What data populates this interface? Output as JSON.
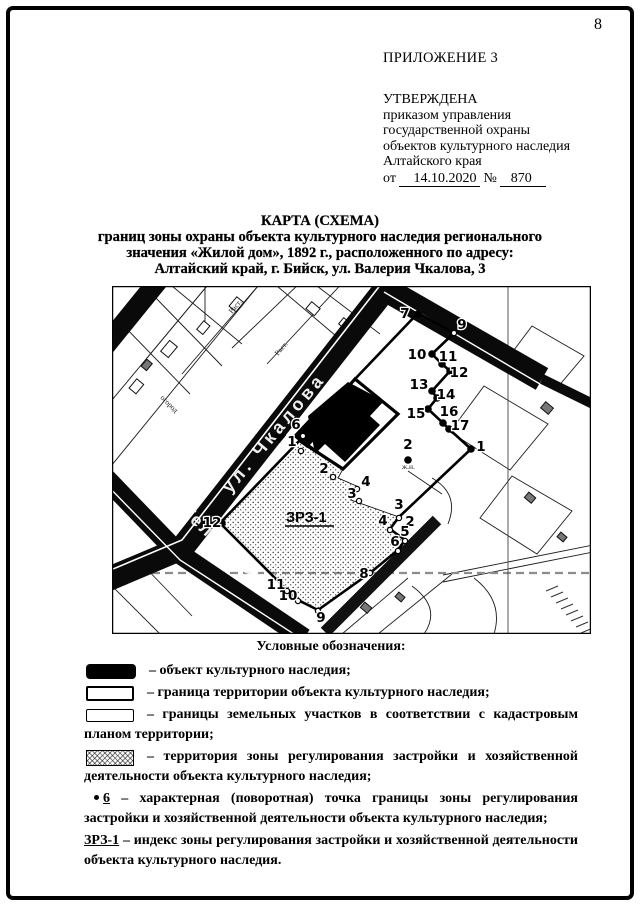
{
  "page": {
    "number": "8"
  },
  "header": {
    "appendix": "ПРИЛОЖЕНИЕ 3",
    "approval_lines": [
      "УТВЕРЖДЕНА",
      "приказом управления",
      "государственной охраны",
      "объектов культурного наследия",
      "Алтайского края"
    ],
    "order_prefix": "от",
    "order_date": "14.10.2020",
    "order_no_sign": "№",
    "order_number": "870"
  },
  "title": {
    "line1": "КАРТА (СХЕМА)",
    "line2": "границ зоны охраны объекта культурного наследия регионального",
    "line3": "значения «Жилой дом», 1892 г., расположенного по адресу:",
    "line4": "Алтайский край, г. Бийск, ул. Валерия Чкалова, 3"
  },
  "map": {
    "streets": [
      {
        "name": "ул. Чкалова"
      },
      {
        "name": "пер. Телеграфный"
      }
    ],
    "zone_label": "ЗРЗ-1",
    "small_labels": [
      "огород",
      "Раст.",
      "Раст.",
      "ж.н."
    ],
    "points": [
      {
        "label": "7",
        "tx": 293,
        "ty": 32,
        "cx": 306,
        "cy": 28
      },
      {
        "label": "9",
        "tx": 350,
        "ty": 43,
        "cx": 342,
        "cy": 47,
        "hollow": true
      },
      {
        "label": "10",
        "tx": 305,
        "ty": 73,
        "cx": 320,
        "cy": 68
      },
      {
        "label": "11",
        "tx": 336,
        "ty": 75,
        "cx": 330,
        "cy": 78
      },
      {
        "label": "12",
        "tx": 347,
        "ty": 91,
        "cx": 338,
        "cy": 85
      },
      {
        "label": "13",
        "tx": 307,
        "ty": 103,
        "cx": 320,
        "cy": 105
      },
      {
        "label": "14",
        "tx": 334,
        "ty": 113,
        "cx": 325,
        "cy": 112
      },
      {
        "label": "15",
        "tx": 304,
        "ty": 132,
        "cx": 316,
        "cy": 123
      },
      {
        "label": "16",
        "tx": 337,
        "ty": 130,
        "cx": 331,
        "cy": 137
      },
      {
        "label": "17",
        "tx": 348,
        "ty": 144,
        "cx": 337,
        "cy": 143
      },
      {
        "label": "1",
        "tx": 369,
        "ty": 165,
        "cx": 359,
        "cy": 163
      },
      {
        "label": "2",
        "tx": 296,
        "ty": 163,
        "cx": 296,
        "cy": 174
      },
      {
        "label": "6",
        "tx": 184,
        "ty": 143,
        "cx": 191,
        "cy": 150,
        "hollow": true
      },
      {
        "label": "1",
        "tx": 180,
        "ty": 160,
        "cx": 189,
        "cy": 165,
        "hollow": true
      },
      {
        "label": "2",
        "tx": 212,
        "ty": 187,
        "cx": 221,
        "cy": 191,
        "hollow": true
      },
      {
        "label": "4",
        "tx": 254,
        "ty": 200,
        "cx": 245,
        "cy": 203,
        "hollow": true
      },
      {
        "label": "3",
        "tx": 240,
        "ty": 212,
        "cx": 247,
        "cy": 215,
        "hollow": true
      },
      {
        "label": "3",
        "tx": 287,
        "ty": 223,
        "cx": 287,
        "cy": 232,
        "hollow": true
      },
      {
        "label": "4",
        "tx": 271,
        "ty": 239,
        "cx": 278,
        "cy": 244,
        "hollow": true
      },
      {
        "label": "2",
        "tx": 298,
        "ty": 240
      },
      {
        "label": "5",
        "tx": 293,
        "ty": 250,
        "cx": 293,
        "cy": 255,
        "hollow": true
      },
      {
        "label": "6",
        "tx": 283,
        "ty": 260,
        "cx": 286,
        "cy": 265,
        "hollow": true
      },
      {
        "label": "8",
        "tx": 252,
        "ty": 292,
        "cx": 258,
        "cy": 287,
        "hollow": true
      },
      {
        "label": "9",
        "tx": 209,
        "ty": 336,
        "cx": 206,
        "cy": 325,
        "hollow": true
      },
      {
        "label": "10",
        "tx": 176,
        "ty": 314,
        "cx": 186,
        "cy": 315,
        "hollow": true
      },
      {
        "label": "11",
        "tx": 164,
        "ty": 303,
        "cx": 175,
        "cy": 305,
        "hollow": true
      },
      {
        "label": "12",
        "tx": 100,
        "ty": 241,
        "cx": 110,
        "cy": 237
      }
    ]
  },
  "legend": {
    "title": "Условные обозначения:",
    "items": [
      {
        "symbol": "heritage-object-swatch",
        "text": "– объект культурного наследия;"
      },
      {
        "symbol": "territory-boundary-swatch",
        "text": "– граница территории объекта культурного наследия;"
      },
      {
        "symbol": "parcel-boundary-swatch",
        "text": "– границы земельных участков в соответствии с кадастровым планом территории;"
      },
      {
        "symbol": "zone-area-swatch",
        "text": "– территория зоны регулирования застройки и хозяйственной деятельности объекта культурного наследия;"
      },
      {
        "symbol": "turning-point-symbol",
        "label": "6",
        "text": "– характерная (поворотная) точка границы зоны регулирования застройки и хозяйственной деятельности объекта культурного наследия;"
      },
      {
        "symbol": "zone-index-symbol",
        "label": "ЗРЗ-1",
        "text": "– индекс зоны регулирования застройки и хозяйственной деятельности объекта культурного наследия."
      }
    ]
  }
}
